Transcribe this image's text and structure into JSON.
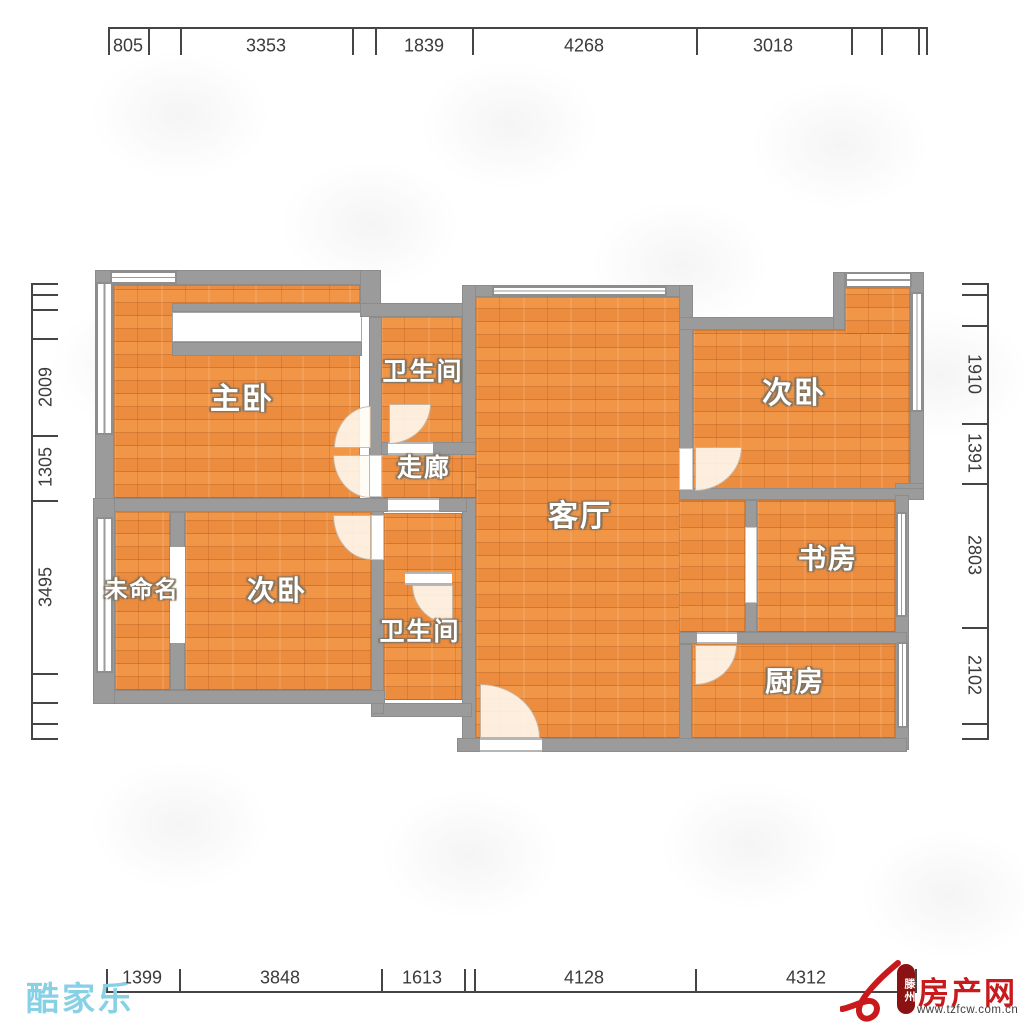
{
  "rooms": {
    "master": "主卧",
    "bath1": "卫生间",
    "corridor": "走廊",
    "living": "客厅",
    "bedroom_tr": "次卧",
    "study": "书房",
    "unnamed": "未命名",
    "bedroom_bl": "次卧",
    "bath2": "卫生间",
    "kitchen": "厨房"
  },
  "dims": {
    "top": [
      "805",
      "3353",
      "1839",
      "4268",
      "3018"
    ],
    "bottom": [
      "1399",
      "3848",
      "1613",
      "4128",
      "4312"
    ],
    "left": [
      "2009",
      "1305",
      "3495"
    ],
    "right": [
      "1910",
      "1391",
      "2803",
      "2102"
    ]
  },
  "logos": {
    "kujiale": "酷家乐",
    "fcw_name": "房产网",
    "fcw_badge": "滕州",
    "fcw_url": "www.tzfcw.com.cn"
  },
  "colors": {
    "floor_orange": "#ec8c3f",
    "wall_gray": "#9b9b9b",
    "dim_text": "#3b3b3b",
    "kujiale_blue": "#87d0e6",
    "fcw_red": "#c9191d",
    "fcw_badge_bg": "#8a1212"
  }
}
